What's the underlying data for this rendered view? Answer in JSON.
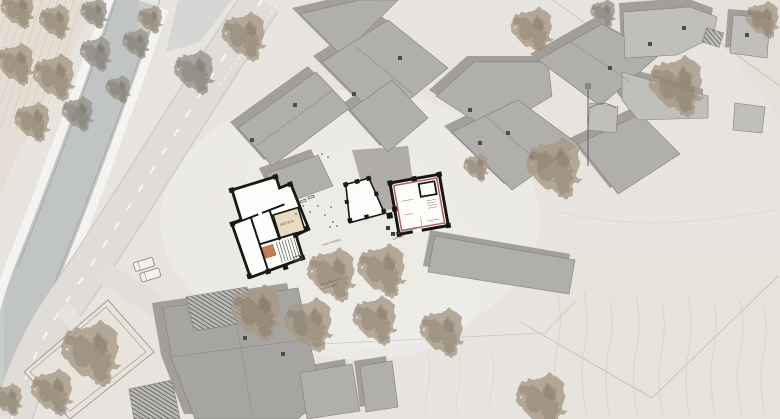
{
  "canvas": {
    "width": 780,
    "height": 419
  },
  "title": "village site plan",
  "labels": {
    "elevation": "1027.5 m",
    "plaza_note": "neuer dorfplatz",
    "surface_note_1": "auf gemeindestrasse",
    "surface_note_2": "kies-sand",
    "fountain_note_1": "alter dorfbrunnen",
    "fountain_note_2": "brunnenplatz"
  },
  "palette": {
    "ground": "#eae7e2",
    "field": "#e3d9cb",
    "river": "#c7cccc",
    "river_bank": "#f4f3f1",
    "road": "#e0ddd9",
    "road_edge": "#c7c4bf",
    "roof_base": "#b2b0ad",
    "roof_light": "#c6c4c0",
    "roof_dark": "#a4a29f",
    "shadow": "#95938e",
    "wall_black": "#181816",
    "accent_red": "#a3493f",
    "room_beige": "#e7dcc1",
    "detail_orange": "#c2703f",
    "tree_brown": "#a79a88",
    "tree_gray": "#98958d",
    "annotation_text": "#6a665f"
  }
}
